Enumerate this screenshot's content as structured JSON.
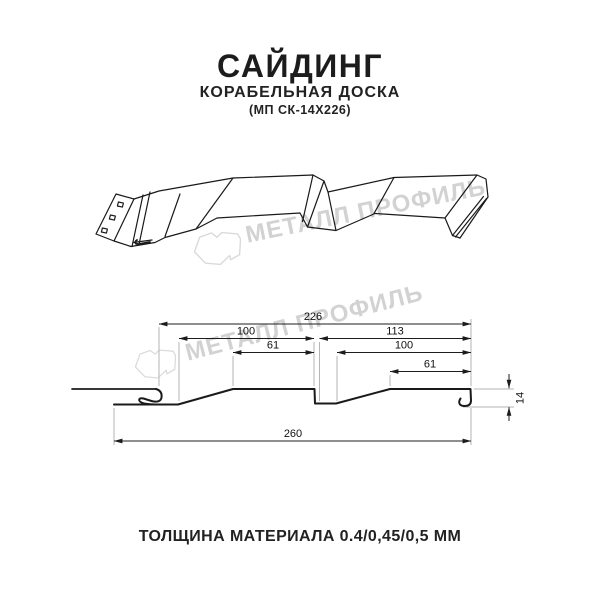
{
  "header": {
    "title": "САЙДИНГ",
    "subtitle": "КОРАБЕЛЬНАЯ ДОСКА",
    "product_code": "(МП СК-14Х226)"
  },
  "watermark": {
    "brand_text": "МЕТАЛЛ ПРОФИЛЬ",
    "logo": "metall-profil-logo",
    "color": "#d2d2d2"
  },
  "cross_section": {
    "dimensions": {
      "total_width": "226",
      "board1_width": "100",
      "board2_width": "113",
      "board1_flat": "61",
      "board2_inner": "100",
      "board2_flat": "61",
      "overall_width": "260",
      "profile_height": "14"
    }
  },
  "footer": {
    "thickness_note": "ТОЛЩИНА МАТЕРИАЛА 0.4/0,45/0,5 ММ"
  },
  "colors": {
    "line": "#1a1a1a",
    "watermark": "#d2d2d2",
    "extension_line": "#b5b5b5"
  }
}
